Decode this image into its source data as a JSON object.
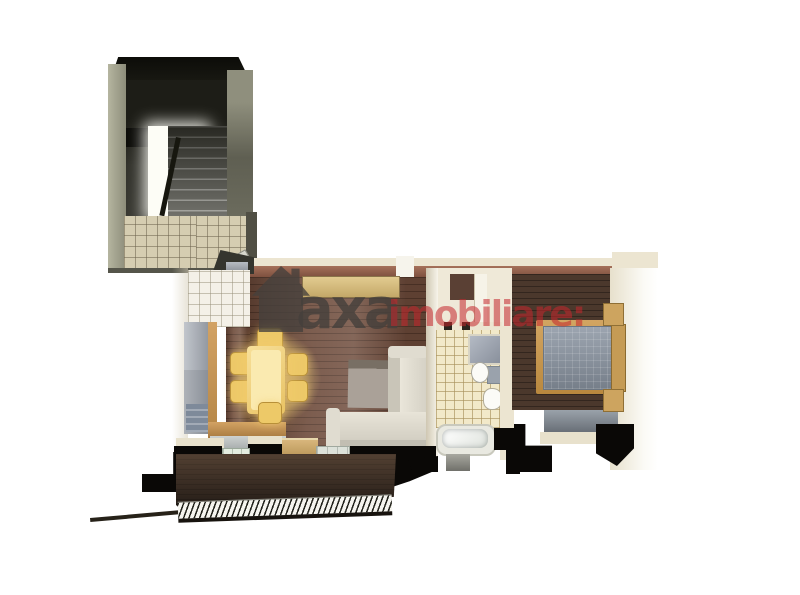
{
  "canvas": {
    "width": 800,
    "height": 595,
    "background": "#ffffff"
  },
  "watermark": {
    "icon": "house-icon",
    "brand": "axa",
    "suffix": "imobiliare:",
    "brand_color": "#45403c",
    "suffix_color": "#c5262c"
  },
  "scene": {
    "type": "3d-apartment-floorplan-render",
    "view": "top-down cutaway",
    "rooms": [
      {
        "name": "stairwell",
        "position": "top-left",
        "features": [
          "staircase",
          "railing",
          "white-landing",
          "beige-tile-floor",
          "dark-cutaway-walls"
        ]
      },
      {
        "name": "kitchen-dining",
        "position": "left",
        "features": [
          "fridge",
          "counter-column",
          "dishwasher",
          "lower-counter",
          "white-tile-floor",
          "dining-table",
          "six-chairs",
          "warm-light-glow"
        ]
      },
      {
        "name": "living-room",
        "position": "center",
        "features": [
          "wood-plank-floor",
          "corner-sofa",
          "gray-rug",
          "sideboard"
        ]
      },
      {
        "name": "bathroom",
        "position": "center-right",
        "features": [
          "cream-tile-floor",
          "bathtub",
          "shower",
          "toilet",
          "sink",
          "mat"
        ]
      },
      {
        "name": "bedroom",
        "position": "right",
        "features": [
          "dark-wood-floor",
          "double-bed",
          "gray-mattress",
          "headboard",
          "two-nightstands",
          "gray-rug"
        ]
      },
      {
        "name": "balcony",
        "position": "bottom",
        "features": [
          "dark-deck",
          "hatched-railing",
          "doormat",
          "balcony-doors"
        ]
      }
    ]
  },
  "palette": {
    "background": "#ffffff",
    "wall-cream": "#ece5d1",
    "wall-rust": "#96664f",
    "wood-floor": "#6d4a3a",
    "wood-floor-dark": "#4b382c",
    "tile-white": "#f4f1e8",
    "tile-beige": "#d5cdb1",
    "tile-bath": "#f2e9c9",
    "stair-wall": "#9c9c88",
    "stair-dark": "#30302a",
    "table-yellow": "#eec868",
    "sofa-cream": "#e6e2d6",
    "fridge-gray": "#a9afb7",
    "counter-wood": "#c9995c",
    "mattress-gray": "#8b95a2",
    "bed-wood": "#c89c5e",
    "rug-gray": "#9aa2aa",
    "balcony-brown": "#3c2f26",
    "shadow-black": "#0a0806",
    "wm-brand": "#45403c",
    "wm-suffix": "#c5262c"
  }
}
